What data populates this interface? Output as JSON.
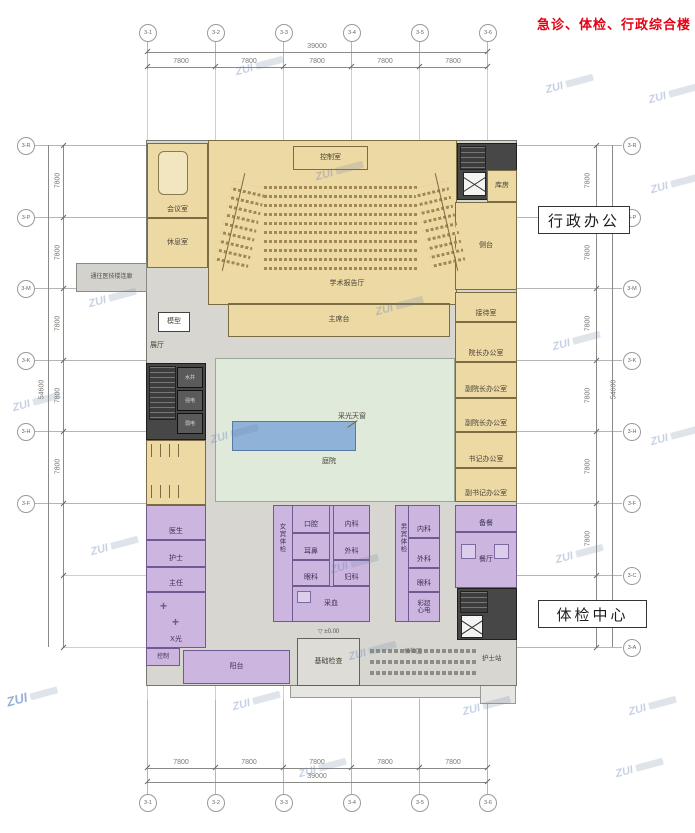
{
  "title": "急诊、体检、行政综合楼",
  "watermark": "ZUI",
  "callouts": {
    "admin": "行政办公",
    "exam": "体检中心"
  },
  "link_label": "通往医技楼连廊",
  "level_mark": "±0.00",
  "grid": {
    "cols": [
      "3-1",
      "3-2",
      "3-3",
      "3-4",
      "3-5",
      "3-6"
    ],
    "rows_left": [
      "3-R",
      "3-P",
      "3-M",
      "3-K",
      "3-H",
      "3-F"
    ],
    "rows_right": [
      "3-R",
      "3-P",
      "3-M",
      "3-K",
      "3-H",
      "3-F",
      "3-C",
      "3-A"
    ]
  },
  "dims": {
    "total_h": "39000",
    "seg_h": "7800",
    "total_v": "54600",
    "seg_v": "7800"
  },
  "rooms": {
    "meeting": "会议室",
    "lounge": "休息室",
    "control_room": "控制室",
    "auditorium": "学术报告厅",
    "stage": "主席台",
    "storage": "库房",
    "side_stage": "侧台",
    "reception": "接待室",
    "director": "院长办公室",
    "vice_director1": "副院长办公室",
    "vice_director2": "副院长办公室",
    "secretary": "书记办公室",
    "vice_secretary": "副书记办公室",
    "model": "模型",
    "exhibition": "展厅",
    "courtyard": "庭院",
    "skylight": "采光天窗",
    "shaft_water": "水井",
    "shaft_strong": "强电",
    "shaft_weak": "弱电",
    "doctor": "医生",
    "nurse": "护士",
    "chief": "主任",
    "xray": "X光",
    "xray_ctrl": "控制",
    "female_hall": "女宾体检",
    "male_hall": "男宾体检",
    "w1": "口腔",
    "w2": "耳鼻",
    "w3": "眼科",
    "w4": "内科",
    "w5": "外科",
    "w6": "妇科",
    "e1": "内科",
    "e2": "外科",
    "e3": "眼科",
    "blood": "采血",
    "ultra_ecg": "彩超心电",
    "prep": "备餐",
    "dining": "餐厅",
    "nurse_station": "护士站",
    "balcony": "阳台",
    "basic_exam": "基础检查",
    "waiting": "候检区"
  }
}
